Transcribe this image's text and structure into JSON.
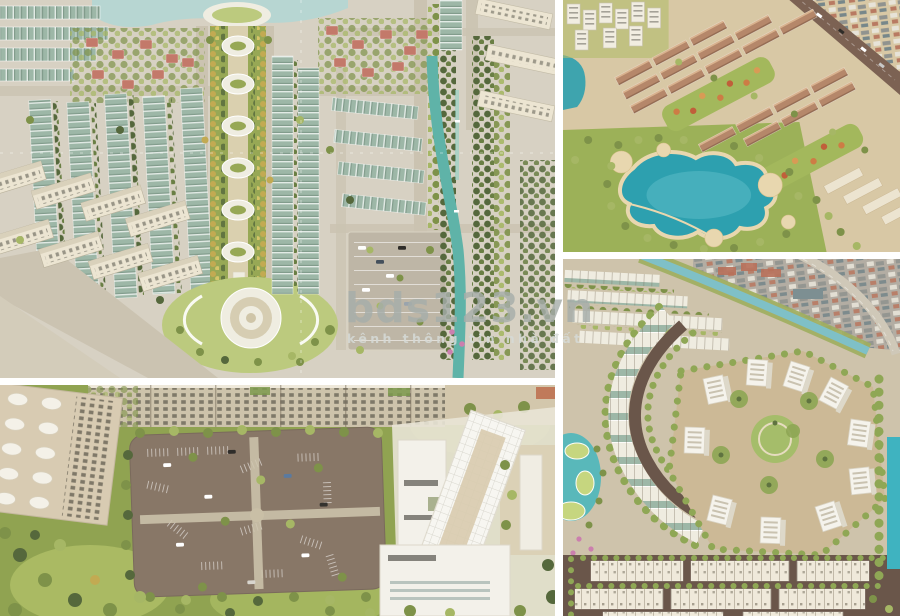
{
  "watermark": {
    "brand": "bds123.vn",
    "tagline": "kênh thông tin nhà đất"
  },
  "panels": [
    {
      "alt": "Aerial render of master plan with central landscaped boulevard, teal-roofed townhouse rows, red-roofed villas, parking lot and tree-lined canal"
    },
    {
      "alt": "Aerial render of tree-lined parking lot with cars beside a white commercial building and beige townhouses"
    },
    {
      "alt": "Aerial render of neighborhood with blue lagoon pool, brown-roofed townhouse rows, white high-rise blocks and main road"
    },
    {
      "alt": "Aerial render of curved residential quarter with white apartment cluster, crescent townhouse rows, pond and canal"
    }
  ],
  "colors": {
    "pageBg": "#ffffff",
    "aGround": "#d7d1c3",
    "aRoad": "#cbc3b1",
    "aWater": "#b7d6d2",
    "aRoofTeal": "#9db7a7",
    "aAxisGreen": "#97a855",
    "aPath": "#dad0af",
    "aLawn": "#bcca7e",
    "aTreeDark": "#55683c",
    "aTreeMid": "#7e9249",
    "aTreeLight": "#a6b765",
    "aTreeYellow": "#c2aa52",
    "aRedRoof": "#c3796a",
    "aCanal": "#5fb3a8",
    "aParking": "#beb6a6",
    "aWhite": "#efede1",
    "aCream": "#ece5d2",
    "bGreen": "#90a351",
    "bAsphalt": "#887767",
    "bGround": "#cdc3ab",
    "bWhite": "#f3f1ea",
    "bGlass": "#afbdb7",
    "bBeige": "#d8cbb2",
    "cTan": "#d8c8a5",
    "cRoofBrown": "#b5876a",
    "cGreen": "#9cb158",
    "cLagoon": "#2da0af",
    "cLagoonLight": "#5bbcc6",
    "cSand": "#e8d7af",
    "cRoad": "#7c6253",
    "cOrange": "#cd7c45",
    "cWhite": "#f1ede1",
    "dGround": "#cec3ab",
    "dPlaza": "#ccb996",
    "dWhite": "#f5f3ec",
    "dGreen": "#8fa755",
    "dLawn": "#a5bd6a",
    "dRoad": "#6a564a",
    "dCanal": "#7fc0c7",
    "dUrban": "#b3ada3",
    "dWater": "#3fb3c0",
    "dPond": "#59b8ba",
    "dCream": "#efe9da",
    "wmText": "rgba(166,173,170,0.82)",
    "wmTag": "rgba(214,219,215,0.85)"
  }
}
